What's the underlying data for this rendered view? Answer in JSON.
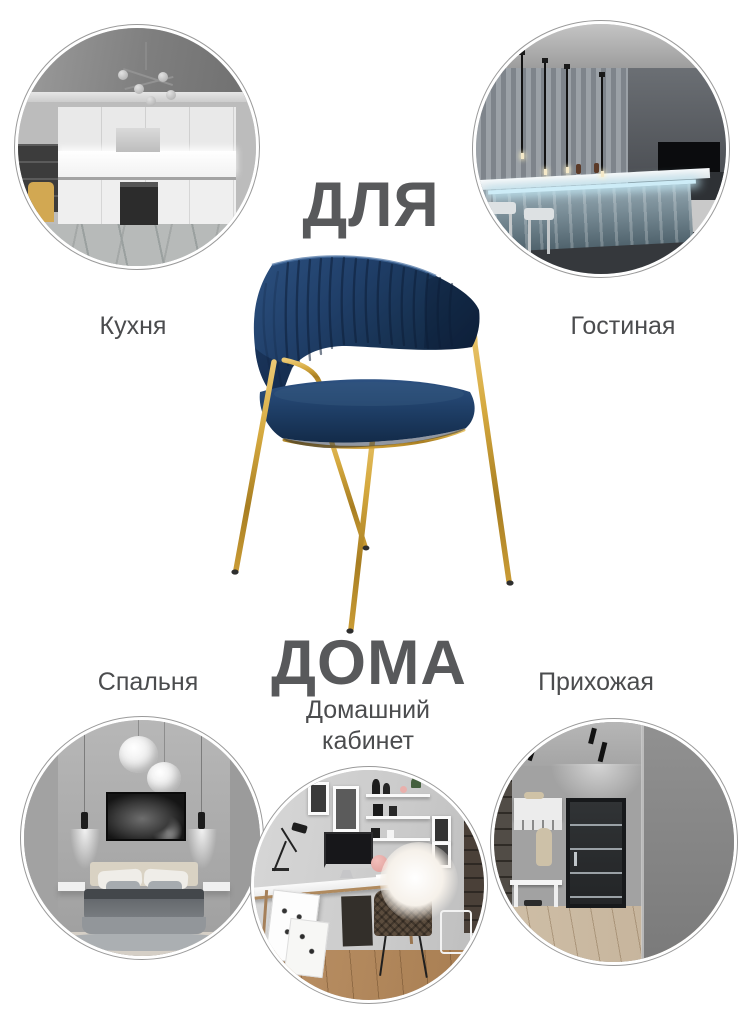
{
  "headline": {
    "top": "ДЛЯ",
    "bottom": "ДОМА"
  },
  "rooms": {
    "kitchen": {
      "label": "Кухня"
    },
    "living": {
      "label": "Гостиная"
    },
    "bedroom": {
      "label": "Спальня"
    },
    "office": {
      "label": "Домашний кабинет"
    },
    "hallway": {
      "label": "Прихожая"
    }
  },
  "product": {
    "velvet_color": "#1e3a5f",
    "gold_color": "#c79a33"
  },
  "canvas": {
    "background": "#ffffff",
    "headline_color": "#58595b",
    "label_color": "#4b4c4e"
  }
}
